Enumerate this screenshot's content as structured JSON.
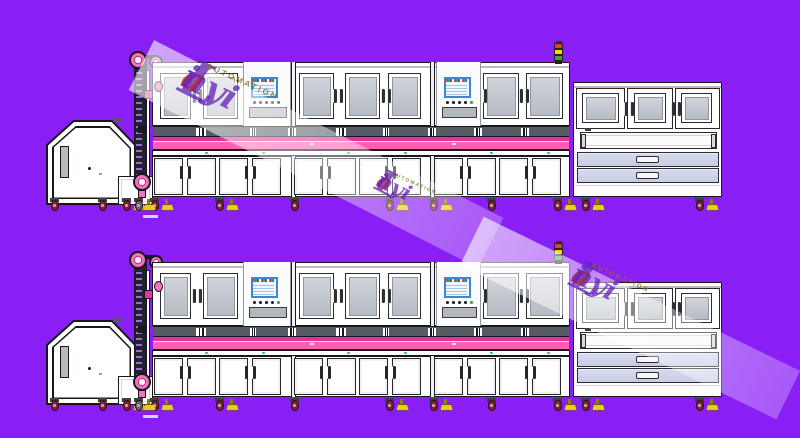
{
  "scene": {
    "description": "Side-elevation CAD render of two identical industrial automation assembly lines on a purple background",
    "background_color": "#8A1FF5",
    "line_count": 2
  },
  "watermark": {
    "brand_initial": "L",
    "brand_pre": "i",
    "brand_accent": "a",
    "brand_rest": "nyi",
    "subtitle": "AUTOMATION",
    "brand_color": "rgba(104,38,186,0.78)",
    "accent_color": "rgba(195,41,31,0.85)",
    "subtitle_color": "rgba(138,118,27,0.85)",
    "stamp_count": 3
  },
  "equipment": {
    "modules_per_line": [
      "hopper-feeder",
      "elevator-conveyor",
      "process-cabinet-bay-1",
      "process-cabinet-bay-2",
      "process-cabinet-bay-3",
      "unload-cabinet-with-drawers"
    ],
    "hmi_screen_count_per_line": 2,
    "drawer_count_per_line": 2,
    "tower_light_colors": [
      "#E53935",
      "#FFD600",
      "#43A047"
    ],
    "colors": {
      "outline_ink": "#17171D",
      "cabinet_white": "#FFFFFF",
      "window_glass_light": "#D0D4DA",
      "window_glass_dark": "#B7BCC4",
      "vision_strip": "#565B63",
      "conveyor_pink_dark": "#E5309B",
      "conveyor_pink": "#FF5FB2",
      "pulley_pink": "#F272BE",
      "pulley_ring": "#C42A88",
      "drawer_lavender": "#C9CEE6",
      "caster_maroon": "#7D2136",
      "foot_yellow": "#E9CB1D",
      "hmi_frame_blue": "#3F86CF",
      "beam_green_dot": "#35C24D"
    }
  }
}
